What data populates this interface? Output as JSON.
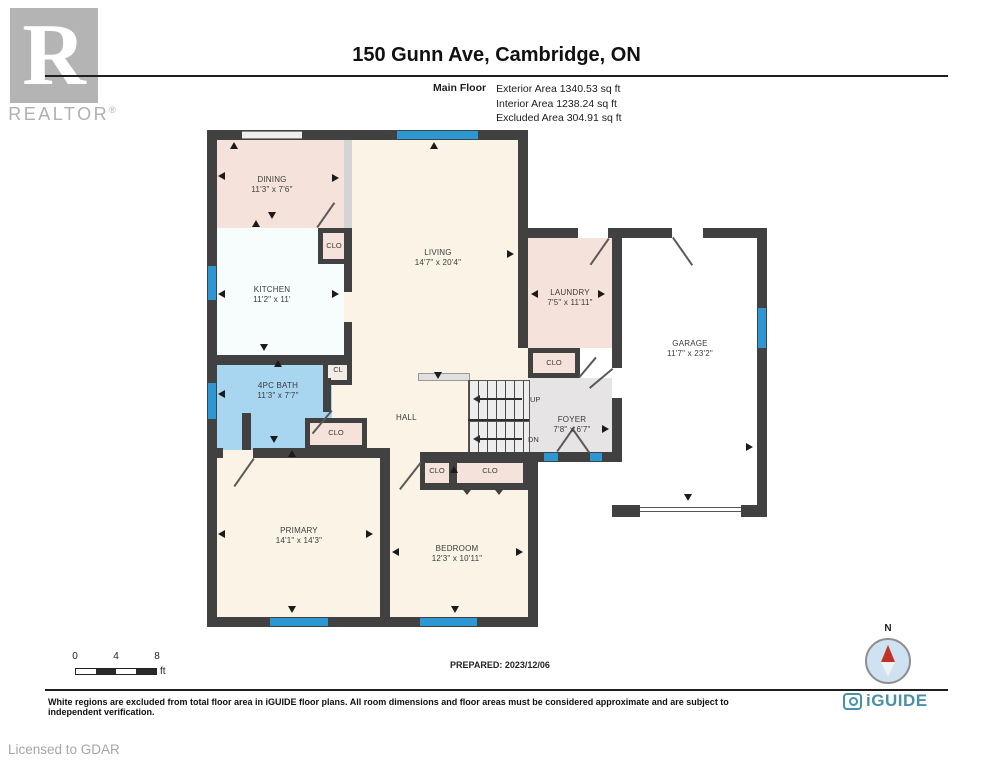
{
  "header": {
    "title": "150 Gunn Ave, Cambridge, ON",
    "floor_label": "Main Floor",
    "areas": [
      "Exterior Area 1340.53 sq ft",
      "Interior Area 1238.24 sq ft",
      "Excluded Area 304.91 sq ft"
    ],
    "realtor_text": "REALTOR",
    "registered": "®",
    "logo_letter": "R"
  },
  "rooms": {
    "dining": {
      "name": "DINING",
      "dims": "11'3\" x 7'6\""
    },
    "kitchen": {
      "name": "KITCHEN",
      "dims": "11'2\" x 11'"
    },
    "living": {
      "name": "LIVING",
      "dims": "14'7\" x 20'4\""
    },
    "laundry": {
      "name": "LAUNDRY",
      "dims": "7'5\" x 11'11\""
    },
    "garage": {
      "name": "GARAGE",
      "dims": "11'7\" x 23'2\""
    },
    "bath": {
      "name": "4PC BATH",
      "dims": "11'3\" x 7'7\""
    },
    "foyer": {
      "name": "FOYER",
      "dims": "7'8\" x 6'7\""
    },
    "primary": {
      "name": "PRIMARY",
      "dims": "14'1\" x 14'3\""
    },
    "bedroom": {
      "name": "BEDROOM",
      "dims": "12'3\" x 10'11\""
    },
    "hall": {
      "name": "HALL"
    }
  },
  "labels": {
    "closet": "CLO",
    "closet_small": "CL",
    "up": "UP",
    "down": "DN"
  },
  "footer": {
    "scale": {
      "ticks": [
        "0",
        "4",
        "8"
      ],
      "unit": "ft"
    },
    "prepared": "PREPARED: 2023/12/06",
    "compass_north": "N",
    "disclaimer": "White regions are excluded from total floor area in iGUIDE floor plans. All room dimensions and floor areas must be considered approximate and are subject to independent verification.",
    "brand": "iGUIDE",
    "licensed": "Licensed to GDAR"
  },
  "colors": {
    "wall": "#414141",
    "window": "#2c97d3",
    "room_pink": "#f5e2da",
    "room_cream": "#faf3e6",
    "room_bath_blue": "#a8d5f0",
    "room_foyer_gray": "#e6e4e5",
    "room_kitchen": "#f7fcfc",
    "room_garage": "#ffffff",
    "brand_teal": "#4891a6",
    "compass_fill": "#cfe2f1",
    "needle_red": "#c23128"
  }
}
